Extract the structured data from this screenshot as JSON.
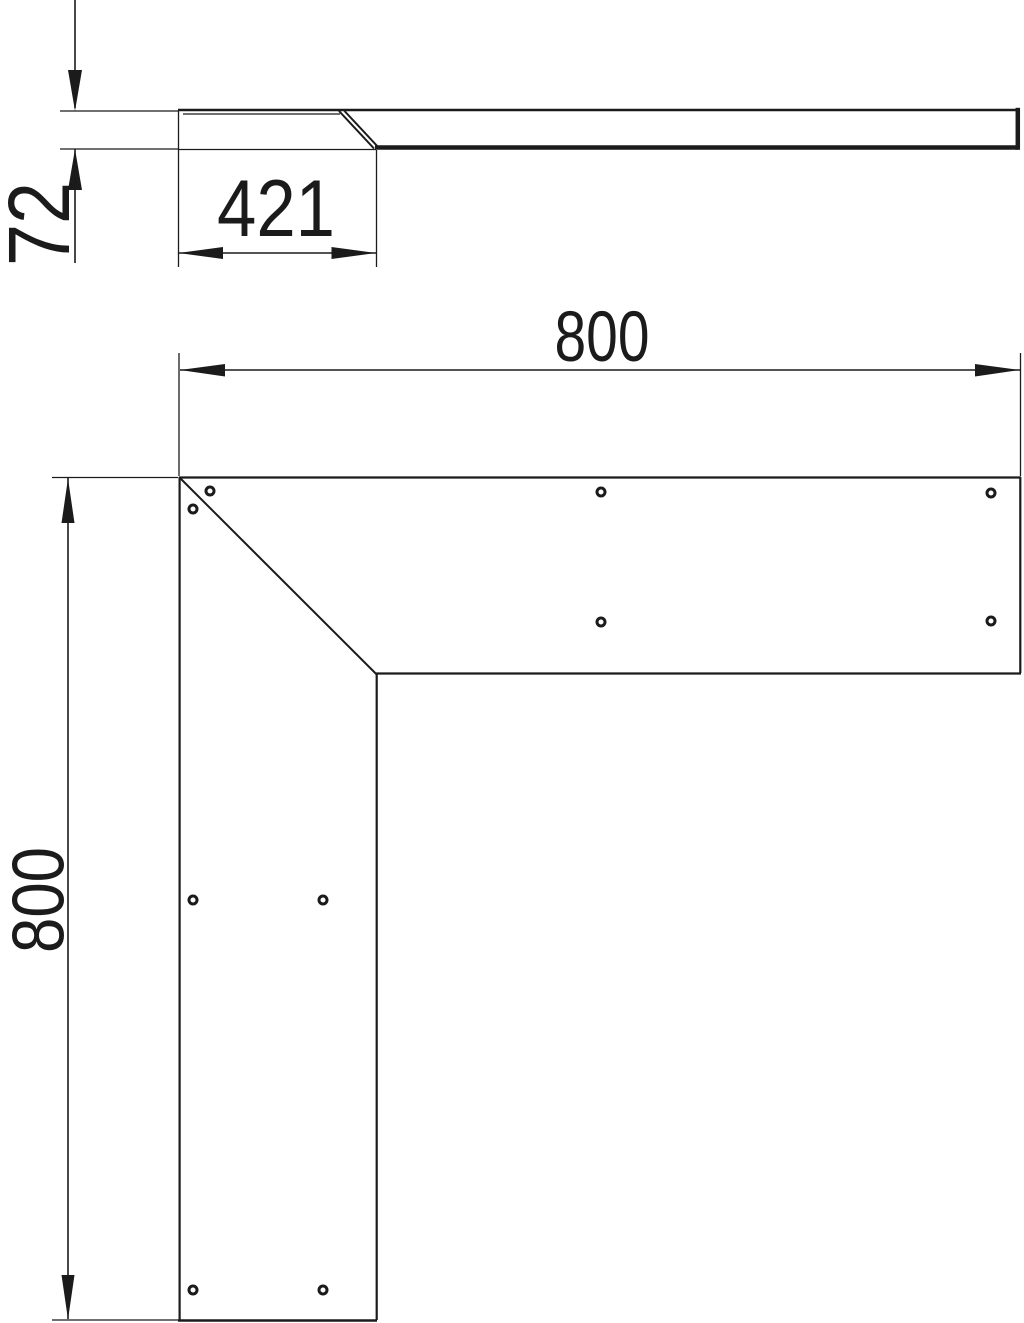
{
  "drawing": {
    "type": "technical-dimension-drawing",
    "description": "Flat angle / internal corner cover piece shown as side profile (top) and L-shaped plan view (bottom) with mounting holes",
    "line_color": "#1b1b1b",
    "bg_color": "#ffffff"
  },
  "side_view": {
    "name": "side-profile-view",
    "height_dim_label": "72",
    "overlap_dim_label": "421"
  },
  "plan_view": {
    "name": "plan-view-l-shape",
    "width_dim_label": "800",
    "height_dim_label": "800",
    "hole_count": 10,
    "holes": [
      {
        "cx": 210,
        "cy": 491
      },
      {
        "cx": 193,
        "cy": 509
      },
      {
        "cx": 601,
        "cy": 492
      },
      {
        "cx": 991,
        "cy": 493
      },
      {
        "cx": 601,
        "cy": 622
      },
      {
        "cx": 991,
        "cy": 621
      },
      {
        "cx": 193,
        "cy": 900
      },
      {
        "cx": 323,
        "cy": 900
      },
      {
        "cx": 193,
        "cy": 1290
      },
      {
        "cx": 323,
        "cy": 1290
      }
    ]
  }
}
